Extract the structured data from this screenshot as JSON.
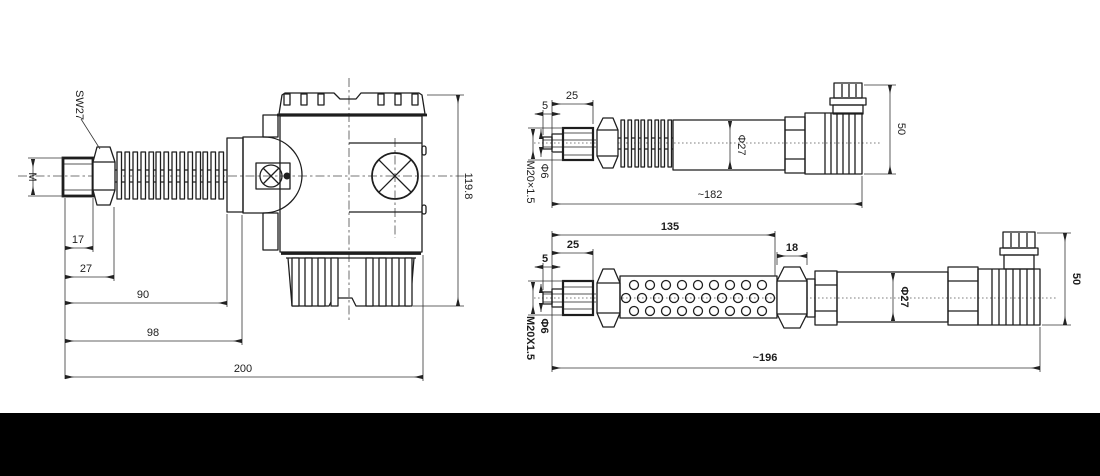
{
  "colors": {
    "line": "#1e1e1e",
    "background": "#ffffff",
    "bottom_bar": "#000000"
  },
  "side_view": {
    "sw27": "SW27",
    "thread": "M",
    "dim_17": "17",
    "dim_27": "27",
    "dim_90": "90",
    "dim_98": "98",
    "dim_200": "200",
    "height": "119.8"
  },
  "upper_view": {
    "dim_5": "5",
    "dim_25": "25",
    "thread": "M20×1.5",
    "bore": "Φ6",
    "diameter": "Φ27",
    "height": "50",
    "length": "~182"
  },
  "lower_view": {
    "dim_5": "5",
    "dim_25": "25",
    "dim_135": "135",
    "dim_18": "18",
    "thread": "M20X1.5",
    "bore": "Φ6",
    "diameter": "Φ27",
    "height": "50",
    "length": "~196"
  }
}
